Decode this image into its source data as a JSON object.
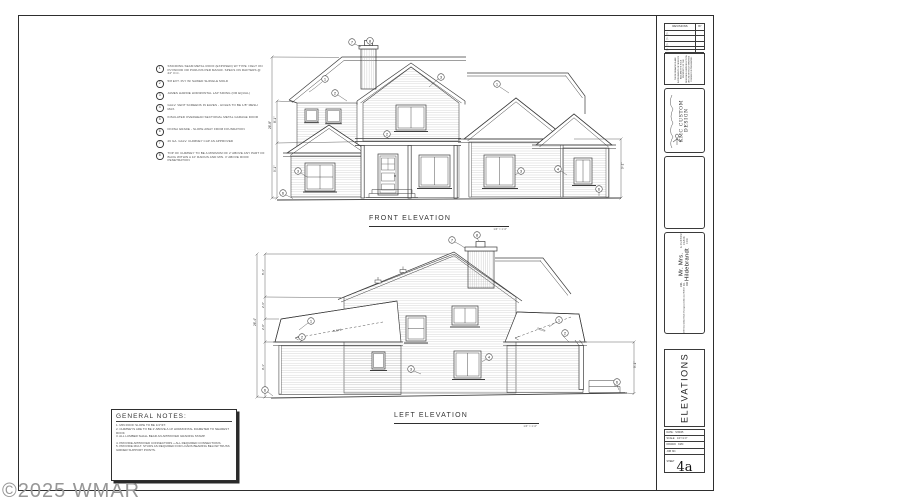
{
  "page": {
    "watermark": "©2025 WMAR"
  },
  "drawings": {
    "front": {
      "title": "FRONT ELEVATION",
      "scale": "1/4\" = 1'-0\""
    },
    "left": {
      "title": "LEFT ELEVATION",
      "scale": "1/4\" = 1'-0\""
    }
  },
  "keynotes": {
    "items": [
      {
        "num": "1",
        "text": "STANDING SEAM METAL ROOF (EXPOSED) W/ TYPE I FELT ON PLYWOOD OR PURLINS PER MANUF. SPECS ON RAFTERS @ 24\" O.C."
      },
      {
        "num": "2",
        "text": "5/8 EXT. PLY W/ SAWED SHINGLE MOLD"
      },
      {
        "num": "3",
        "text": "JAMES HARDIE HORIZONTAL LAP SIDING (OR EQUAL)"
      },
      {
        "num": "4",
        "text": "GALV. VENT SCREENS IN EAVES - HOLES TO BE 1/8\" MESH MAX."
      },
      {
        "num": "5",
        "text": "INSULATED OVERHEAD SECTIONAL METAL GARAGE DOOR"
      },
      {
        "num": "6",
        "text": "FINISH GRADE - SLOPE AWAY FROM FOUNDATION"
      },
      {
        "num": "7",
        "text": "26 GA. GALV. CHIMNEY CAP AS APPROVED"
      },
      {
        "num": "8",
        "text": "TOP OF CHIMNEY TO BE A MINIMUM OF 2' ABOVE ANY PART OF BLDG WITHIN A 10' RADIUS AND MIN. 3' ABOVE ROOF PENETRATION"
      }
    ]
  },
  "general_notes": {
    "title": "GENERAL NOTES:",
    "items": [
      "1.  MIN ROOF SLOPE TO BE 1/4\"/FT.",
      "2.  CHIMNEYS ARE TO BE 2' ABOVE A 10' HORIZONTAL DIAMETER TO NEAREST ROOF.",
      "3.  ALL LUMBER SHALL BEAR AN APPROVED GRADING STAMP.",
      "4.  PROVIDE APPROVED CONNECTORS + ALL REQUIRED CONNECTIONS.",
      "5.  PROVIDE MULT. STUDS AS REQUIRED FOR LOADS BEARING BELOW TRUSS GIRDER SUPPORT POINTS."
    ]
  },
  "dimensions": {
    "front": {
      "overall": "26'-8\"",
      "upper": "8'-1\"",
      "lower": "9'-1\"",
      "right": "9'-1\""
    },
    "left": {
      "overall": "26'-4\"",
      "seg1": "8'-1\"",
      "seg2": "2'-6\"",
      "seg3": "2'-0\"",
      "seg4": "9'-1\"",
      "right": "9'-1\"",
      "slope": "SLOPE"
    }
  },
  "title_block": {
    "revisions": {
      "title": "REVISIONS",
      "by": "BY",
      "mark": "△"
    },
    "disclaimer": "THESE DRAWINGS ARE INSTRUMENTS OF SERVICE AND ARE THE SOLE PROPERTY OF THE DESIGNER. REPRODUCTION OR USE WITHOUT WRITTEN CONSENT IS PROHIBITED.",
    "firm": {
      "name": "KMC CUSTOM DESIGN"
    },
    "project": {
      "prefix": "A CUSTOM CABIN FOR",
      "client": "Mr. Mrs. Hildebrandt",
      "parcel": "208-49-033",
      "address": "268 Snowblind Club",
      "city": "Overgaard, Arizona 85933"
    },
    "sheet_title": "ELEVATIONS",
    "info": {
      "date_label": "DATE:",
      "date": "5/30/05",
      "scale_label": "SCALE:",
      "scale": "1/4\"=1'-0\"",
      "drawn_label": "DRAWN:",
      "drawn": "KMC",
      "job_label": "JOB NO.",
      "job": "",
      "sheet_label": "SHEET",
      "number": "4a"
    }
  }
}
